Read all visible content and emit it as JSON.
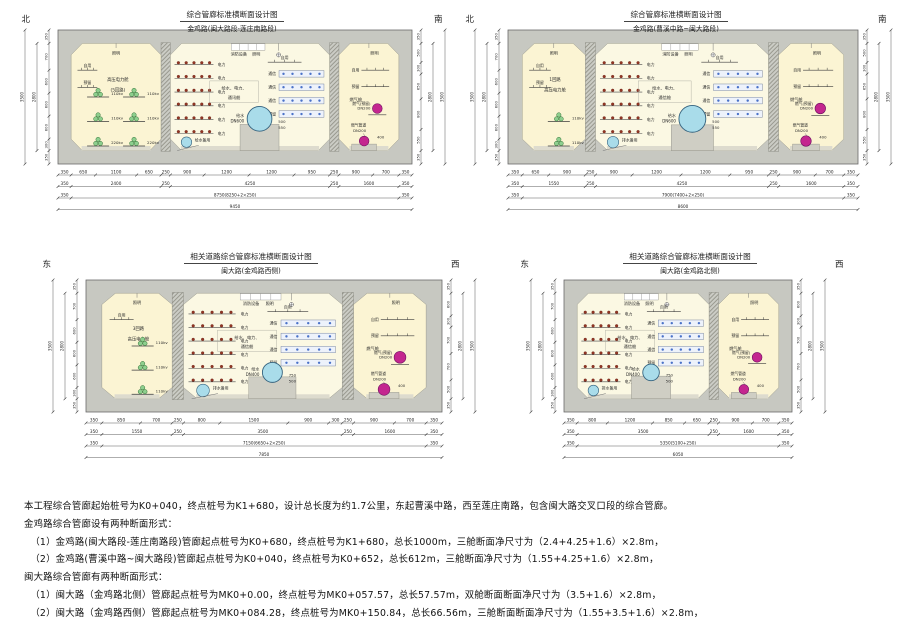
{
  "colors": {
    "concrete": "#c7c8c1",
    "interior": "#fbf4d3",
    "interior_mid": "#fbf8e3",
    "floor": "#dddbce",
    "pedestal": "#cfcec4",
    "water": "#a9dcea",
    "gas": "#c4268f",
    "cable": "#8ecf8e",
    "tray_dot": "#943524",
    "comm_bg": "#edf2fb",
    "comm_dot": "#4a72c8"
  },
  "sections": [
    {
      "title": "综合管廊标准横断面设计图",
      "subtitle": "金鸡路(闽大路段-莲庄南路段)",
      "compass_left": "北",
      "compass_right": "南",
      "total_mm": 9450,
      "compartments": [
        {
          "type": "power",
          "width_mm": 2400,
          "top_label": "照明",
          "shelf_labels": [
            "自用",
            "预留"
          ],
          "name_lines": [
            "高压电力舱",
            "(5回路)"
          ],
          "cable_cols": [
            [
              "110kv",
              "110kv",
              "220kv"
            ],
            [
              "110kv",
              "110kv",
              "220kv"
            ]
          ]
        },
        {
          "type": "utility",
          "width_mm": 4250,
          "top_left_label": "消防设备",
          "top_right_label": "照明",
          "self_label": "自用",
          "name_lines": [
            "给水、电力、",
            "通讯舱"
          ],
          "power_trays": [
            "电力",
            "电力",
            "电力",
            "电力",
            "电力",
            "电力"
          ],
          "comm_trays": [
            "通信",
            "通信",
            "通信",
            "预留"
          ],
          "water_labels": [
            "给水",
            "DN600"
          ],
          "water_dn": 600,
          "drain_label": "给水备用",
          "ped_dims": [
            "500",
            "550"
          ]
        },
        {
          "type": "gas",
          "width_mm": 1600,
          "name": "燃气舱",
          "top_label": "照明",
          "shelf_labels": [
            "自用",
            "预留"
          ],
          "c1_labels": [
            "燃气(预留)",
            "DN200"
          ],
          "c2_labels": [
            "燃气管道",
            "DN200"
          ],
          "ped_dim": "400"
        }
      ],
      "dims": {
        "row1": [
          "350",
          "650",
          "1100",
          "650",
          "250",
          "900",
          "1200",
          "1200",
          "950",
          "250",
          "900",
          "700",
          "350"
        ],
        "row2": [
          "350",
          "2400",
          "250",
          "4250",
          "250",
          "1600",
          "350"
        ],
        "row3": [
          "350",
          "8750(8250+2×250)",
          "350"
        ],
        "row4": [
          "9450"
        ]
      },
      "vdims": {
        "left": [
          "350",
          "700",
          "600",
          "600",
          "600",
          "300",
          "350"
        ],
        "right": [
          "350",
          "500",
          "300",
          "650",
          "800",
          "550",
          "350"
        ],
        "inner": "2800",
        "total": "3500"
      }
    },
    {
      "title": "综合管廊标准横断面设计图",
      "subtitle": "金鸡路(曹溪中路~闽大路段)",
      "compass_left": "北",
      "compass_right": "南",
      "total_mm": 8600,
      "compartments": [
        {
          "type": "power",
          "width_mm": 1550,
          "top_label": "照明",
          "shelf_labels": [
            "自用",
            "预留"
          ],
          "name_lines": [
            "1回路",
            "高压电力舱"
          ],
          "cable_cols": [
            [
              "110kv",
              "110kv"
            ]
          ]
        },
        {
          "type": "utility",
          "width_mm": 4250,
          "top_left_label": "消防设备",
          "top_right_label": "照明",
          "self_label": "自用",
          "name_lines": [
            "给水、电力、",
            "通信舱"
          ],
          "power_trays": [
            "电力",
            "电力",
            "电力",
            "电力",
            "电力",
            "电力"
          ],
          "comm_trays": [
            "通信",
            "通信",
            "通信",
            "预留"
          ],
          "water_labels": [
            "给水",
            "DN600"
          ],
          "water_dn": 600,
          "drain_label": "排水备用",
          "ped_dims": [
            "500",
            "550"
          ]
        },
        {
          "type": "gas",
          "width_mm": 1600,
          "name": "燃气舱",
          "top_label": "照明",
          "shelf_labels": [
            "自用",
            "预留"
          ],
          "c1_labels": [
            "燃气(预留)",
            "DN200"
          ],
          "c2_labels": [
            "燃气管道",
            "DN200"
          ],
          "ped_dim": "400"
        }
      ],
      "dims": {
        "row1": [
          "350",
          "650",
          "900",
          "250",
          "900",
          "1200",
          "1200",
          "950",
          "250",
          "900",
          "700",
          "350"
        ],
        "row2": [
          "350",
          "1550",
          "250",
          "4250",
          "250",
          "1600",
          "350"
        ],
        "row3": [
          "350",
          "7900(7400+2×250)",
          "350"
        ],
        "row4": [
          "8600"
        ]
      },
      "vdims": {
        "left": [
          "350",
          "700",
          "600",
          "600",
          "600",
          "300",
          "350"
        ],
        "right": [
          "350",
          "500",
          "300",
          "650",
          "800",
          "550",
          "350"
        ],
        "inner": "2800",
        "total": "3500"
      }
    },
    {
      "title": "相关道路综合管廊标准横断面设计图",
      "subtitle": "闽大路(金鸡路西侧)",
      "compass_left": "东",
      "compass_right": "西",
      "total_mm": 7850,
      "compartments": [
        {
          "type": "power",
          "width_mm": 1550,
          "top_label": "照明",
          "shelf_labels": [
            "自用"
          ],
          "name_lines": [
            "3回路",
            "高压电力舱"
          ],
          "cable_cols": [
            [
              "110kv",
              "110kv",
              "110kv"
            ]
          ]
        },
        {
          "type": "utility",
          "width_mm": 3500,
          "top_left_label": "消防设备",
          "top_right_label": "照明",
          "self_label": "自用",
          "name_lines": [
            "给水、电力、",
            "通信舱"
          ],
          "power_trays": [
            "电力",
            "电力",
            "电力",
            "电力",
            "电力",
            "电力"
          ],
          "comm_trays": [
            "通信",
            "通信",
            "通信",
            "预留"
          ],
          "water_labels": [
            "给水",
            "DN400"
          ],
          "water_dn": 400,
          "drain_label": "排水备用",
          "ped_dims": [
            "750",
            "500"
          ]
        },
        {
          "type": "gas",
          "width_mm": 1600,
          "name": "燃气舱",
          "top_label": "照明",
          "shelf_labels": [
            "自用",
            "预留"
          ],
          "c1_labels": [
            "燃气(预留)",
            "DN200"
          ],
          "c2_labels": [
            "燃气管道",
            "DN200"
          ],
          "ped_dim": "400"
        }
      ],
      "dims": {
        "row1": [
          "350",
          "850",
          "700",
          "250",
          "800",
          "1500",
          "900",
          "300",
          "250",
          "900",
          "700",
          "350"
        ],
        "row2": [
          "350",
          "1550",
          "250",
          "3500",
          "250",
          "1600",
          "350"
        ],
        "row3": [
          "350",
          "7150(6650+2×250)",
          "350"
        ],
        "row4": [
          "7850"
        ]
      },
      "vdims": {
        "left": [
          "350",
          "700",
          "600",
          "600",
          "600",
          "300",
          "350"
        ],
        "right": [
          "350",
          "600",
          "300",
          "700",
          "700",
          "500",
          "350"
        ],
        "inner": "2800",
        "total": "3500"
      }
    },
    {
      "title": "相关道路综合管廊标准横断面设计图",
      "subtitle": "闽大路(金鸡路北侧)",
      "compass_left": "东",
      "compass_right": "西",
      "total_mm": 6050,
      "compartments": [
        {
          "type": "utility",
          "width_mm": 3500,
          "top_left_label": "消防设备",
          "top_right_label": "照明",
          "self_label": "自用",
          "name_lines": [
            "给水、电力、",
            "通信舱"
          ],
          "power_trays": [
            "电力",
            "电力",
            "电力",
            "电力",
            "电力",
            "电力"
          ],
          "comm_trays": [
            "通信",
            "通信",
            "通信",
            "预留"
          ],
          "water_labels": [
            "给水",
            "DN400"
          ],
          "water_dn": 400,
          "drain_label": "排水备用",
          "ped_dims": [
            "750",
            "500"
          ]
        },
        {
          "type": "gas",
          "width_mm": 1600,
          "name": "燃气舱",
          "top_label": "照明",
          "shelf_labels": [
            "自用",
            "预留"
          ],
          "c1_labels": [
            "燃气(预留)",
            "DN200"
          ],
          "c2_labels": [
            "燃气管道",
            "DN200"
          ],
          "ped_dim": "400"
        }
      ],
      "dims": {
        "row1": [
          "350",
          "800",
          "1200",
          "850",
          "650",
          "250",
          "900",
          "700",
          "350"
        ],
        "row2": [
          "350",
          "3500",
          "250",
          "1600",
          "350"
        ],
        "row3": [
          "350",
          "5350(5100+250)",
          "350"
        ],
        "row4": [
          "6050"
        ]
      },
      "vdims": {
        "left": [
          "350",
          "700",
          "600",
          "600",
          "600",
          "300",
          "350"
        ],
        "right": [
          "350",
          "600",
          "300",
          "700",
          "700",
          "500",
          "350"
        ],
        "inner": "2800",
        "total": "3500"
      }
    }
  ],
  "notes": {
    "lines": [
      "本工程综合管廊起始桩号为K0+040，终点桩号为K1+680，设计总长度为约1.7公里，东起曹溪中路，西至莲庄南路，包含闽大路交叉口段的综合管廊。",
      "金鸡路综合管廊设有两种断面形式：",
      "  （1）金鸡路(闽大路段-莲庄南路段)管廊起点桩号为K0+680，终点桩号为K1+680，总长1000m，三舱断面净尺寸为（2.4+4.25+1.6）×2.8m，",
      "  （2）金鸡路(曹溪中路~闽大路段)管廊起点桩号为K0+040，终点桩号为K0+652，总长612m，三舱断面净尺寸为（1.55+4.25+1.6）×2.8m，",
      "闽大路综合管廊有两种断面形式：",
      "  （1）闽大路（金鸡路北侧）管廊起点桩号为MK0+0.00，终点桩号为MK0+057.57，总长57.57m，双舱断面断面净尺寸为（3.5+1.6）×2.8m，",
      "  （2）闽大路（金鸡路西侧）管廊起点桩号为MK0+084.28，终点桩号为MK0+150.84，总长66.56m，三舱断面断面净尺寸为（1.55+3.5+1.6）×2.8m，"
    ]
  }
}
